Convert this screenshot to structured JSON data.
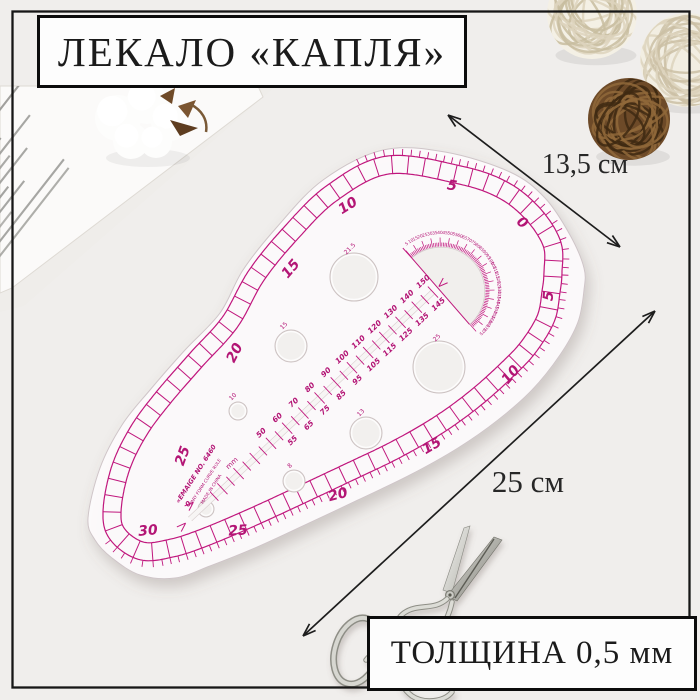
{
  "photo": {
    "background": "#f0eeec",
    "frame_color": "#161616"
  },
  "title": {
    "text": "ЛЕКАЛО «КАПЛЯ»"
  },
  "thickness": {
    "text": "ТОЛЩИНА 0,5 мм"
  },
  "dimensions": {
    "width": {
      "label": "13,5 см"
    },
    "length": {
      "label": "25 см"
    },
    "arrow_color": "#1d1d1d"
  },
  "ruler": {
    "ink": "#c0187d",
    "ink_soft": "#d want",
    "number_color": "#b31274",
    "outer_scale_numbers": [
      {
        "v": "5",
        "x": 452,
        "y": 186,
        "r": 10
      },
      {
        "v": "10",
        "x": 348,
        "y": 206,
        "r": -32
      },
      {
        "v": "15",
        "x": 291,
        "y": 269,
        "r": -50
      },
      {
        "v": "20",
        "x": 235,
        "y": 353,
        "r": -63
      },
      {
        "v": "25",
        "x": 183,
        "y": 456,
        "r": -70
      }
    ],
    "inner_scale_numbers": [
      {
        "v": "0",
        "x": 522,
        "y": 223,
        "r": 40
      },
      {
        "v": "5",
        "x": 549,
        "y": 296,
        "r": -85
      },
      {
        "v": "10",
        "x": 511,
        "y": 375,
        "r": -50
      },
      {
        "v": "15",
        "x": 432,
        "y": 446,
        "r": -30
      },
      {
        "v": "20",
        "x": 338,
        "y": 495,
        "r": -14
      },
      {
        "v": "25",
        "x": 238,
        "y": 531,
        "r": -4
      },
      {
        "v": "30",
        "x": 148,
        "y": 531,
        "r": -5
      }
    ],
    "slot": {
      "numbers_above": [
        "50",
        "60",
        "70",
        "80",
        "90",
        "100",
        "110",
        "120",
        "130",
        "140",
        "150"
      ],
      "numbers_below": [
        "55",
        "65",
        "75",
        "85",
        "95",
        "105",
        "115",
        "125",
        "135",
        "145"
      ],
      "unit": "mm",
      "zero": "0"
    },
    "protractor": {
      "from": 5,
      "to": 175,
      "step": 5
    },
    "holes": [
      {
        "label": "21.5",
        "x": 354,
        "y": 277,
        "rad": 24,
        "lx": 350,
        "ly": 249
      },
      {
        "label": "15",
        "x": 291,
        "y": 346,
        "rad": 16,
        "lx": 284,
        "ly": 326
      },
      {
        "label": "25",
        "x": 439,
        "y": 367,
        "rad": 26,
        "lx": 437,
        "ly": 338
      },
      {
        "label": "13",
        "x": 366,
        "y": 433,
        "rad": 16,
        "lx": 361,
        "ly": 413
      },
      {
        "label": "10",
        "x": 238,
        "y": 411,
        "rad": 9,
        "lx": 233,
        "ly": 397
      },
      {
        "label": "8",
        "x": 294,
        "y": 481,
        "rad": 11,
        "lx": 290,
        "ly": 466
      },
      {
        "label": "",
        "x": 206,
        "y": 509,
        "rad": 8,
        "lx": 0,
        "ly": 0
      }
    ],
    "brand_lines": [
      "«EMAIGE NO. 6460",
      "VARY FORM CURVE RULE",
      "MADE IN CHINA"
    ]
  }
}
